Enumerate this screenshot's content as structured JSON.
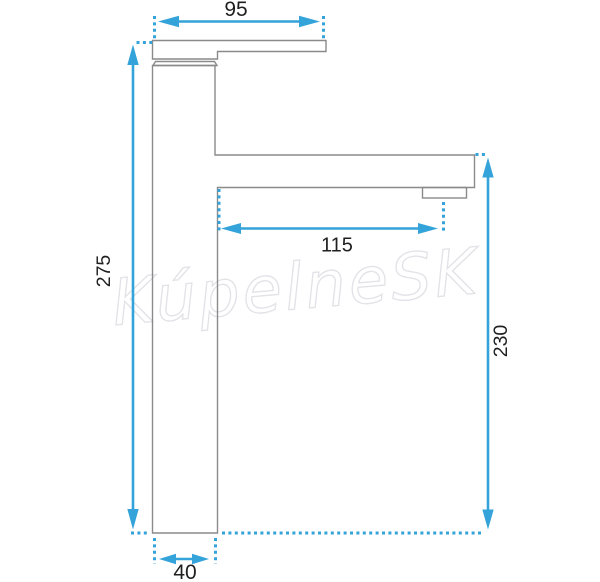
{
  "figure": {
    "type": "technical-dimension-drawing",
    "subject": "single-lever tall basin faucet, side view"
  },
  "watermark": {
    "text": "KúpelneSK",
    "color": "#e2e2e7"
  },
  "colors": {
    "accent_blue": "#33a3d9",
    "outline_gray": "#8a8a8a",
    "label_black": "#1f1f1f",
    "background": "#ffffff"
  },
  "dimensions": {
    "lever_length": {
      "label": "95",
      "value": 95,
      "orientation": "horizontal",
      "position": "top"
    },
    "total_height": {
      "label": "275",
      "value": 275,
      "orientation": "vertical",
      "position": "left"
    },
    "spout_reach": {
      "label": "115",
      "value": 115,
      "orientation": "horizontal",
      "position": "middle"
    },
    "spout_height": {
      "label": "230",
      "value": 230,
      "orientation": "vertical",
      "position": "right"
    },
    "base_width": {
      "label": "40",
      "value": 40,
      "orientation": "horizontal",
      "position": "bottom"
    }
  }
}
